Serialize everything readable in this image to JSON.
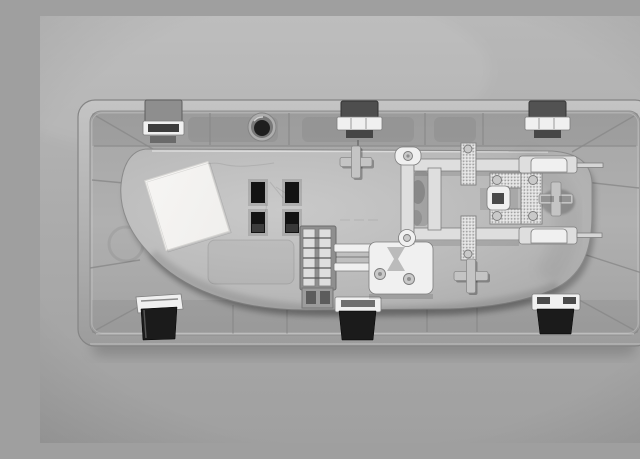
{
  "scene": {
    "type": "photograph",
    "subject": "Rear side of a gray plastic automotive interior dome-light housing",
    "description": "Grayscale product photo of the back of a rectangular automotive overhead/interior lamp unit lying on a plain gray surface. The outer mounting bezel has rounded corners, ribbed sloped inner walls, three metal spring clips on the top edge and three on the bottom edge. The rounded central lamp body carries a blank white label sticker, four black rectangular switch openings in a 2x2 grid, a wiring connector socket with bright metal terminals, a riveted stamped-metal bus-bar circuit with a knurled bulb-contact frame, two bulb contact strips with thin pins reaching the right wall, three cross-shaped screw bosses and one round screw hole in the top rail.",
    "background": "plain neutral gray studio surface",
    "monochrome": true
  },
  "palette": {
    "background_top": "#b8b8b8",
    "background_mid": "#ababab",
    "background_bottom": "#a0a0a0",
    "frame_light": "#c4c4c4",
    "frame_mid": "#b0b0b0",
    "frame_dark": "#9c9c9c",
    "housing_light": "#c9c9c9",
    "housing_mid": "#b9b9b9",
    "housing_edge": "#a9a9a9",
    "metal_bright": "#f0f0f0",
    "metal_mid": "#dedede",
    "metal_outline": "#7e7e7e",
    "clip_dark": "#1b1b1b",
    "hole_black": "#131313",
    "label_white": "#f0efed",
    "line_dark": "#8a8a8a",
    "shadow_dark": "#5f5f5f"
  },
  "parts": {
    "bezel": "rectangular outer mounting frame, rounded corners, ribbed inner walls",
    "spring_clips_top": 3,
    "spring_clips_bottom": 3,
    "lamp_housing": "rounded central body",
    "label_sticker": {
      "text": "",
      "note": "blank white sticker, tilted"
    },
    "switch_openings": 4,
    "bus_bar": "stamped sheet-metal conductor circuit with rivets",
    "bulb_contact_terminals": 2,
    "connector_socket": "wiring connector with two bright terminal pins",
    "screw_bosses_cross": 3,
    "screw_holes_round": 1
  }
}
